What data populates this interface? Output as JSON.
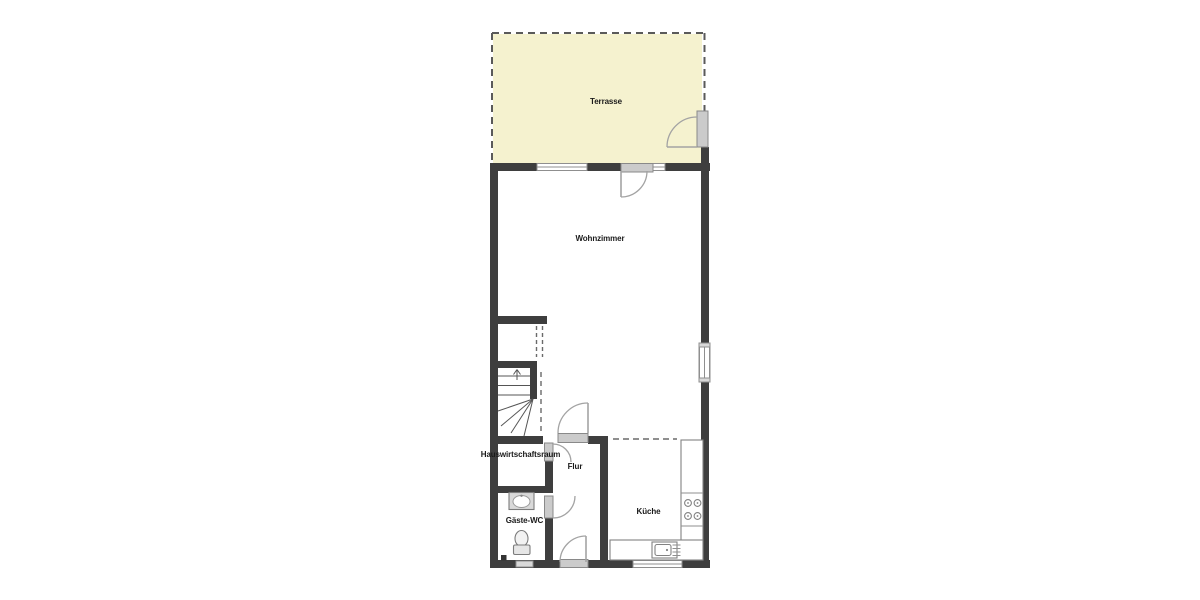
{
  "plan": {
    "rooms": [
      {
        "id": "terrasse",
        "label": "Terrasse"
      },
      {
        "id": "wohnzimmer",
        "label": "Wohnzimmer"
      },
      {
        "id": "hauswirtschaftsraum",
        "label": "Hauswirtschaftsraum"
      },
      {
        "id": "flur",
        "label": "Flur"
      },
      {
        "id": "gaeste-wc",
        "label": "Gäste-WC"
      },
      {
        "id": "kueche",
        "label": "Küche"
      }
    ],
    "colors": {
      "wall": "#3e3e3e",
      "terrace_fill": "#f5f2cf",
      "door_panel": "#cbcbcb",
      "swing_arc": "#a3a3a3",
      "background": "#ffffff"
    },
    "fixtures": [
      {
        "id": "stairs",
        "name": "staircase-up-icon"
      },
      {
        "id": "washbasin",
        "name": "washbasin-icon"
      },
      {
        "id": "toilet",
        "name": "toilet-icon"
      },
      {
        "id": "kitchen-counter",
        "name": "kitchen-counter"
      },
      {
        "id": "cooktop",
        "name": "cooktop-icon"
      },
      {
        "id": "kitchen-sink",
        "name": "kitchen-sink-icon"
      },
      {
        "id": "dishwasher",
        "name": "dishwasher-grill-icon"
      }
    ]
  }
}
